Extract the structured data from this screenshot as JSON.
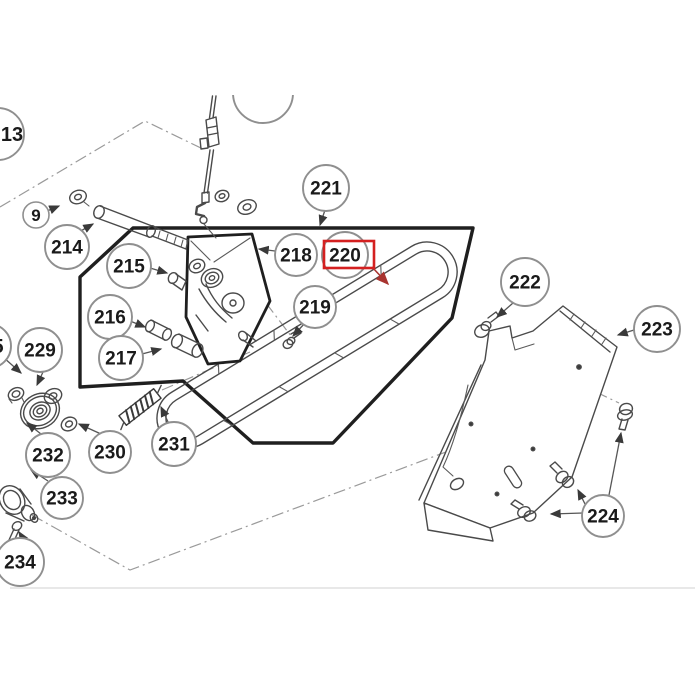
{
  "figure": {
    "type": "exploded-parts-diagram",
    "background": "#ffffff",
    "line_color": "#4a4a4a",
    "outline_color": "#1f1f1f",
    "callout_stroke": "#8f8f8f",
    "text_color": "#1a1a1a",
    "highlight_color": "#d42020",
    "highlighted_part": "220"
  },
  "callouts": [
    {
      "label": "13",
      "cx": -2,
      "cy": 134,
      "r": 26,
      "tx": 12,
      "partial": true
    },
    {
      "label": "9",
      "cx": 36,
      "cy": 215,
      "r": 13
    },
    {
      "label": "214",
      "cx": 67,
      "cy": 247,
      "r": 22
    },
    {
      "label": "215",
      "cx": 129,
      "cy": 266,
      "r": 22
    },
    {
      "label": "216",
      "cx": 110,
      "cy": 317,
      "r": 22
    },
    {
      "label": "217",
      "cx": 121,
      "cy": 358,
      "r": 22
    },
    {
      "label": "218",
      "cx": 296,
      "cy": 255,
      "r": 21
    },
    {
      "label": "219",
      "cx": 315,
      "cy": 307,
      "r": 21
    },
    {
      "label": "220",
      "cx": 345,
      "cy": 255,
      "r": 23,
      "highlighted": true
    },
    {
      "label": "221",
      "cx": 326,
      "cy": 188,
      "r": 23
    },
    {
      "label": "222",
      "cx": 525,
      "cy": 282,
      "r": 24
    },
    {
      "label": "223",
      "cx": 657,
      "cy": 329,
      "r": 23
    },
    {
      "label": "224",
      "cx": 603,
      "cy": 516,
      "r": 21
    },
    {
      "label": "229",
      "cx": 40,
      "cy": 350,
      "r": 22
    },
    {
      "label": "230",
      "cx": 110,
      "cy": 452,
      "r": 21
    },
    {
      "label": "231",
      "cx": 174,
      "cy": 444,
      "r": 22
    },
    {
      "label": "232",
      "cx": 48,
      "cy": 455,
      "r": 22
    },
    {
      "label": "233",
      "cx": 62,
      "cy": 498,
      "r": 21
    },
    {
      "label": "234",
      "cx": 20,
      "cy": 562,
      "r": 24,
      "partial": true
    },
    {
      "label": "5",
      "cx": -11,
      "cy": 346,
      "r": 22,
      "tx": -2,
      "partial": true
    },
    {
      "label": "",
      "cx": 263,
      "cy": 93,
      "r": 30,
      "partial": true
    }
  ],
  "red_box": {
    "x": 324,
    "y": 241,
    "w": 50,
    "h": 27
  }
}
